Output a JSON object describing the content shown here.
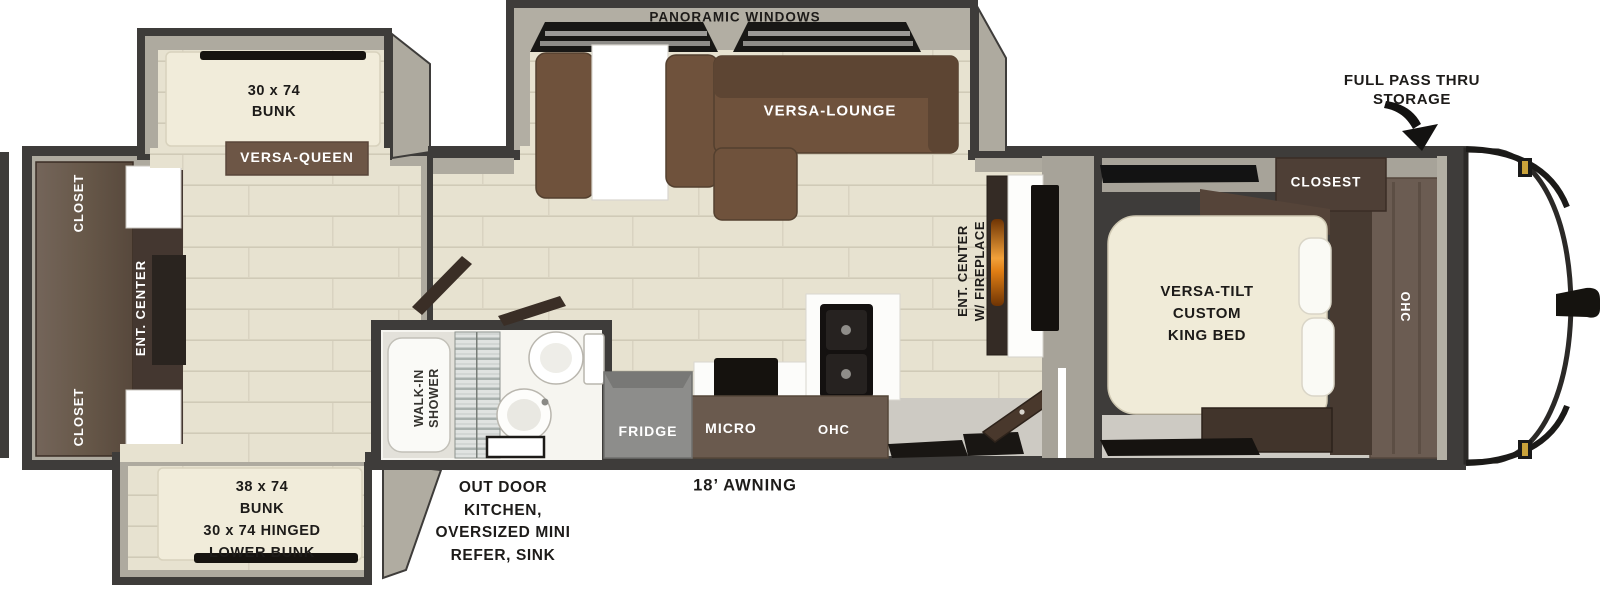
{
  "bunk_room": {
    "top_bunk": "30 x 74\nBUNK",
    "versa_queen": "VERSA-QUEEN",
    "closet_top": "CLOSET",
    "ent_center": "ENT. CENTER",
    "closet_bottom": "CLOSET",
    "lower_bunk": "38 x 74\nBUNK\n30 x 74 HINGED\nLOWER BUNK"
  },
  "bathroom": {
    "walk_in_shower": "WALK-IN\nSHOWER"
  },
  "living": {
    "panoramic_windows": "PANORAMIC WINDOWS",
    "versa_lounge": "VERSA-LOUNGE",
    "ent_center_fireplace": "ENT. CENTER\nW/ FIREPLACE"
  },
  "kitchen": {
    "fridge": "FRIDGE",
    "micro": "MICRO",
    "ohc": "OHC"
  },
  "bedroom": {
    "closet": "CLOSEST",
    "king_bed": "VERSA-TILT\nCUSTOM\nKING BED",
    "ohc": "OHC"
  },
  "exterior": {
    "full_pass_thru_storage": "FULL PASS THRU\nSTORAGE",
    "outdoor_kitchen": "OUT DOOR\nKITCHEN,\nOVERSIZED MINI\nREFER, SINK",
    "awning": "18’ AWNING"
  },
  "colors": {
    "wall_dark": "#3e3c3a",
    "wall_face": "#aeaa9f",
    "floor": "#e7e2d0",
    "plank_line": "#d0cab7",
    "cabinet_dark": "#4a3b32",
    "cabinet_wood": "#6b5c52",
    "sofa": "#6f523c",
    "sofa_dark": "#5d4533",
    "mattress": "#f1ecda",
    "queen_band": "#6d5646",
    "fridge_gray": "#8d8d8b",
    "counter_brown": "#6a5a4e",
    "appliance_black": "#15120e",
    "fireplace_orange": "#f2a13a"
  }
}
